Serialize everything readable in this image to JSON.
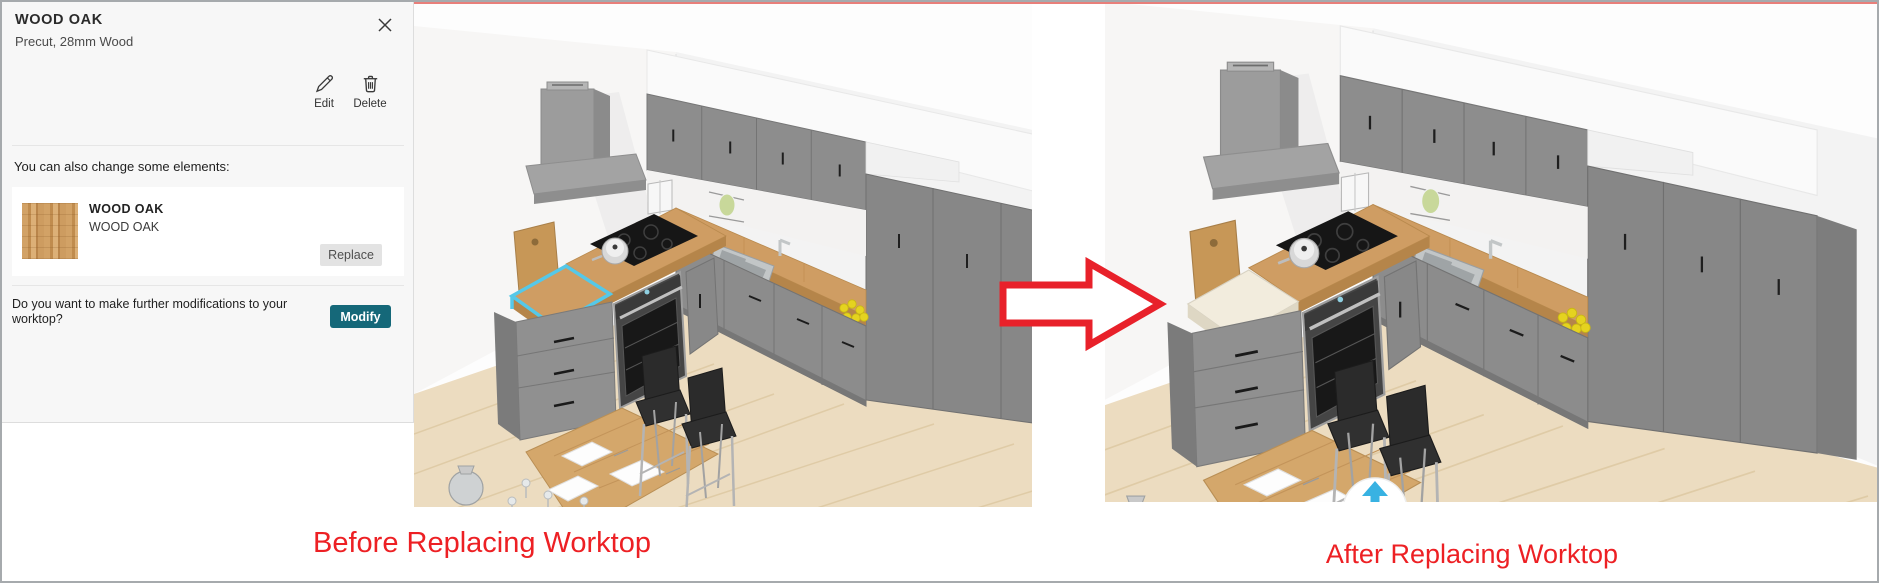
{
  "panel": {
    "title": "WOOD OAK",
    "subtitle": "Precut, 28mm Wood",
    "actions": {
      "edit": "Edit",
      "delete": "Delete"
    },
    "change_hint": "You can also change some elements:",
    "element_card": {
      "name": "WOOD OAK",
      "description": "WOOD OAK",
      "replace_label": "Replace"
    },
    "modify_question": "Do you want to make further modifications to your worktop?",
    "modify_label": "Modify"
  },
  "captions": {
    "before": "Before Replacing Worktop",
    "after": "After Replacing Worktop"
  },
  "icons": [
    "close-icon",
    "pencil-icon",
    "trash-icon",
    "rotate-up-arrow-icon"
  ],
  "colors": {
    "caption_red": "#ed2024",
    "arrow_red": "#e8212a",
    "modify_teal": "#156879",
    "selection_cyan": "#55c8e8",
    "compass_blue": "#38b2e2",
    "worktop_wood": "#cf9d63",
    "worktop_wood_edge": "#b5854a",
    "replaced_worktop": "#f2ecdd",
    "replaced_worktop_edge": "#ded7c4",
    "cabinet_gray": "#8d8d8d",
    "floor_wood": "#ecdcc0"
  }
}
